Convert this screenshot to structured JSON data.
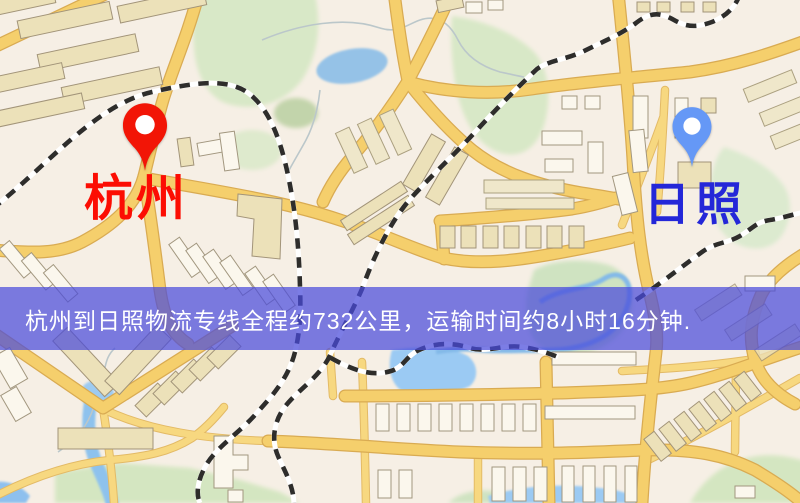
{
  "window": {
    "width": 800,
    "height": 503
  },
  "map": {
    "type": "stylized-city-street-map",
    "colors": {
      "background": "#f6efe5",
      "road_major": "#f4cf6f",
      "road_casing": "#d8ab55",
      "road_minor": "#f6d883",
      "building_tan": "#ece1ba",
      "building_white": "#fbf7ed",
      "park_green": "#d8e8c8",
      "water_blue": "#9ccaf2",
      "railway": "#2e2d2b"
    }
  },
  "markers": [
    {
      "id": "origin",
      "label": "杭州",
      "pin_color": "#f21506",
      "label_color": "#fc0d03",
      "pin_style": "red-map-pin"
    },
    {
      "id": "destination",
      "label": "日照",
      "pin_color": "#6598f6",
      "label_color": "#2427d8",
      "pin_style": "blue-map-pin"
    }
  ],
  "banner": {
    "text": "杭州到日照物流专线全程约732公里，运输时间约8小时16分钟.",
    "background": "rgba(74,75,219,0.72)",
    "text_color": "#ffffff"
  },
  "route": {
    "origin": "杭州",
    "destination": "日照",
    "service": "物流专线",
    "distance": "约732公里",
    "duration": "约8小时16分钟"
  }
}
